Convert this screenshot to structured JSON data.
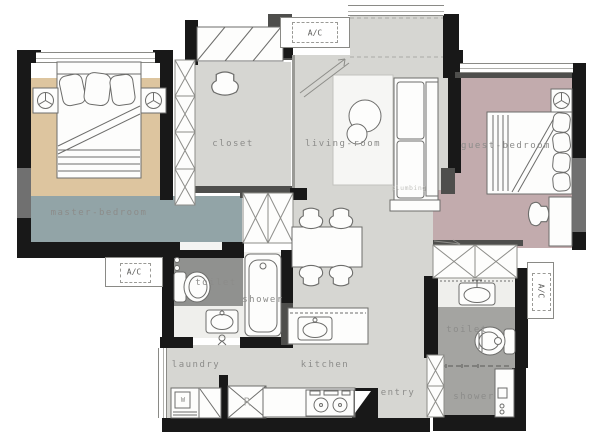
{
  "rooms": {
    "master": {
      "label": "master-bedroom"
    },
    "closet": {
      "label": "closet"
    },
    "living": {
      "label": "living-room"
    },
    "guest": {
      "label": "guest-bedroom"
    },
    "toilet_main": {
      "label": "toilet"
    },
    "shower_main": {
      "label": "shower"
    },
    "laundry": {
      "label": "laundry"
    },
    "kitchen": {
      "label": "kitchen"
    },
    "entry": {
      "label": "entry"
    },
    "toilet_second": {
      "label": "toilet"
    },
    "shower_second": {
      "label": "shower"
    }
  },
  "hvac": {
    "top": "A/C",
    "left": "A/C",
    "right": "A/C"
  },
  "appliances": {
    "washer": "W",
    "fridge": "R"
  },
  "annotations": {
    "plumbing": "plumbing"
  },
  "colors": {
    "wall": "#181818",
    "wall_gray": "#4e4e4c",
    "wall_light": "#707070",
    "floor_light": "#d6d6d2",
    "floor_mid": "#a4a4a1",
    "floor_dark": "#90918f",
    "floor_white": "#efefec",
    "master_rug": "#ddc59f",
    "master_floor": "#92a4a7",
    "guest_floor": "#c2abad",
    "label": "#8c8c8a"
  }
}
